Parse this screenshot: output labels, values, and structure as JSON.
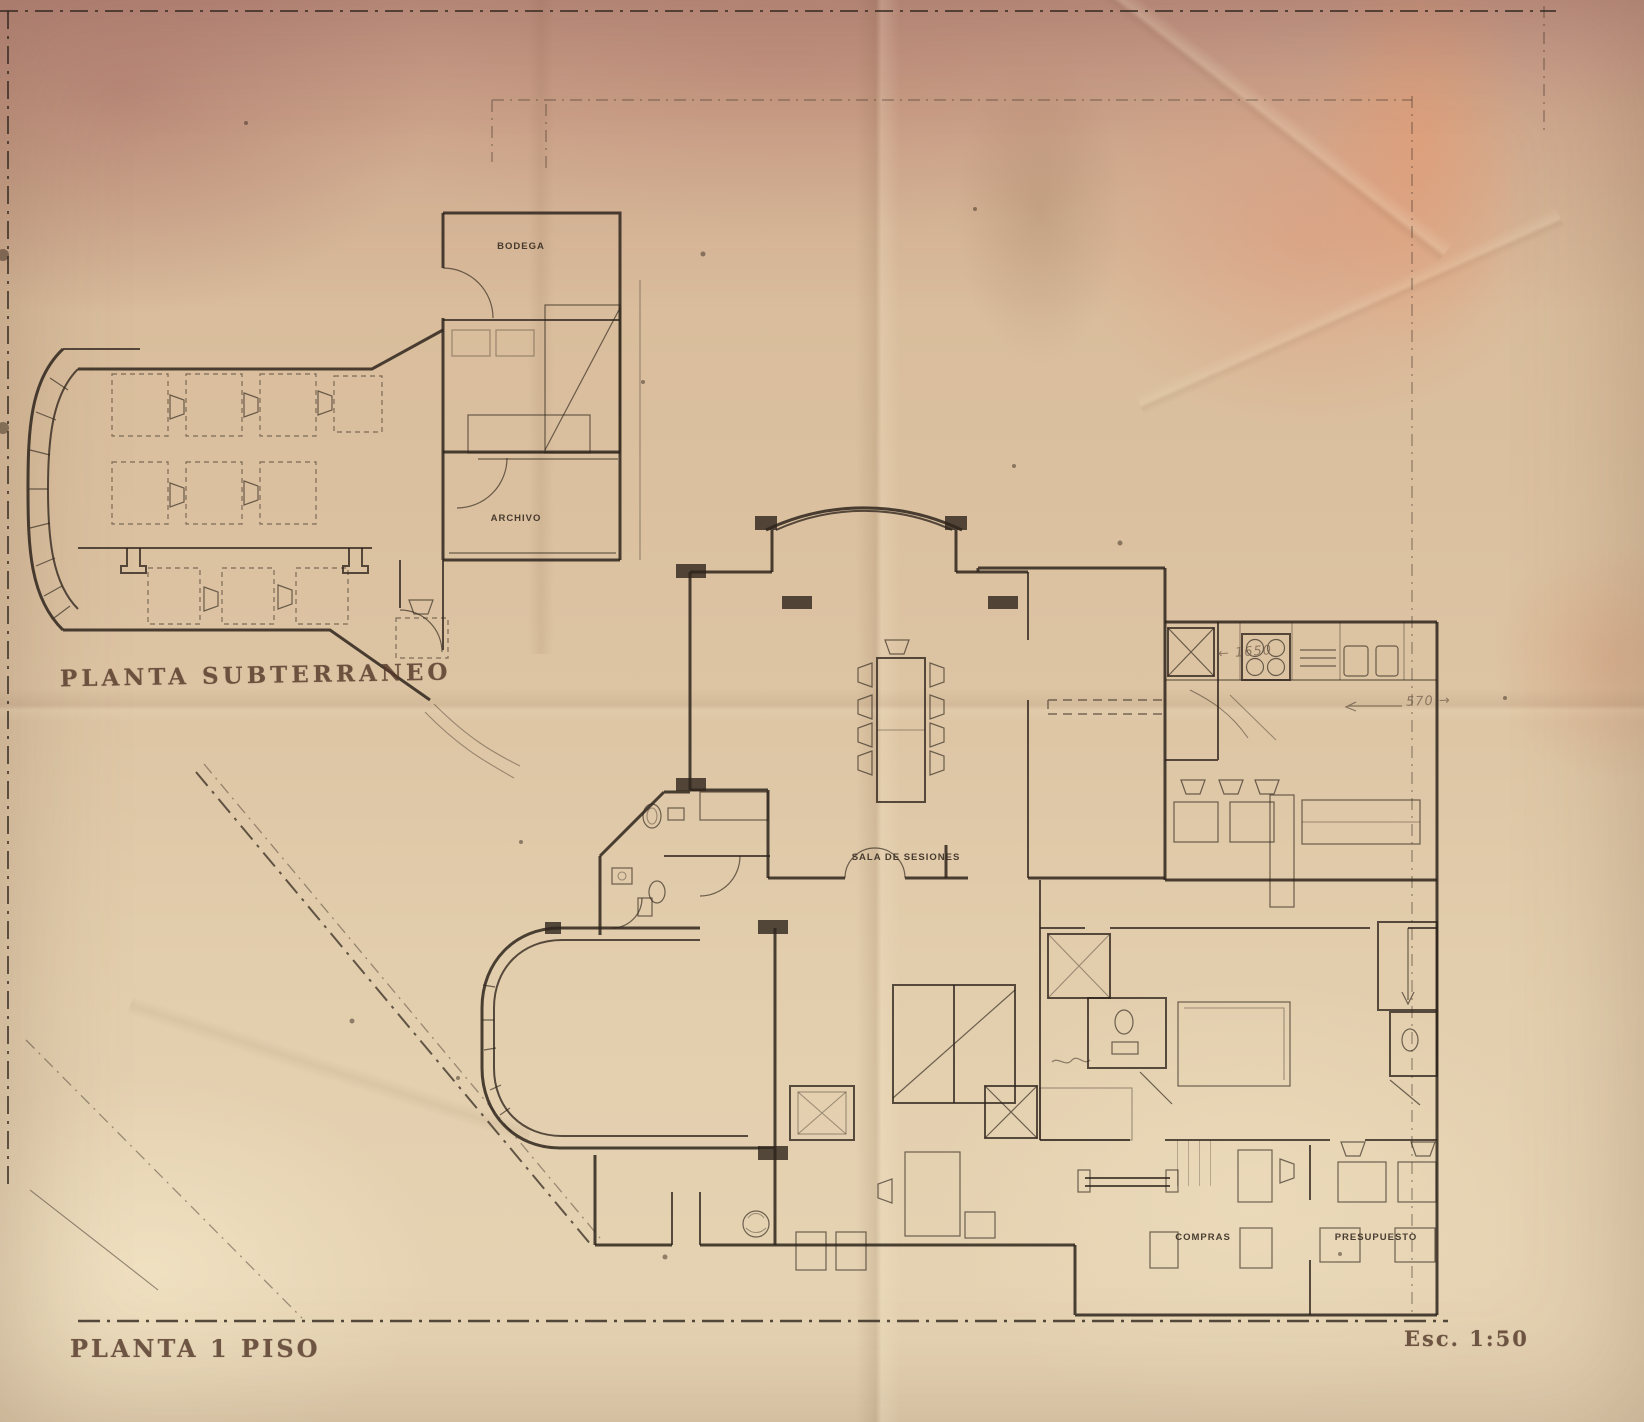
{
  "titles": {
    "basement": "PLANTA SUBTERRANEO",
    "first_floor": "PLANTA 1 PISO"
  },
  "scale_label": "Esc. 1:50",
  "room_labels": {
    "bodega": "BODEGA",
    "archivo": "ARCHIVO",
    "sala_de_sesiones": "SALA DE SESIONES",
    "compras": "COMPRAS",
    "presupuesto": "PRESUPUESTO"
  },
  "pencil_annotations": {
    "dim_1650": "← 1650",
    "dim_570": "570 →"
  },
  "colors": {
    "paper_base": "#dcc3a2",
    "paper_pink": "#c29384",
    "paper_cream": "#e6d4b4",
    "ink": "#2e241c",
    "pencil": "#6e5948",
    "label": "#33281f"
  }
}
